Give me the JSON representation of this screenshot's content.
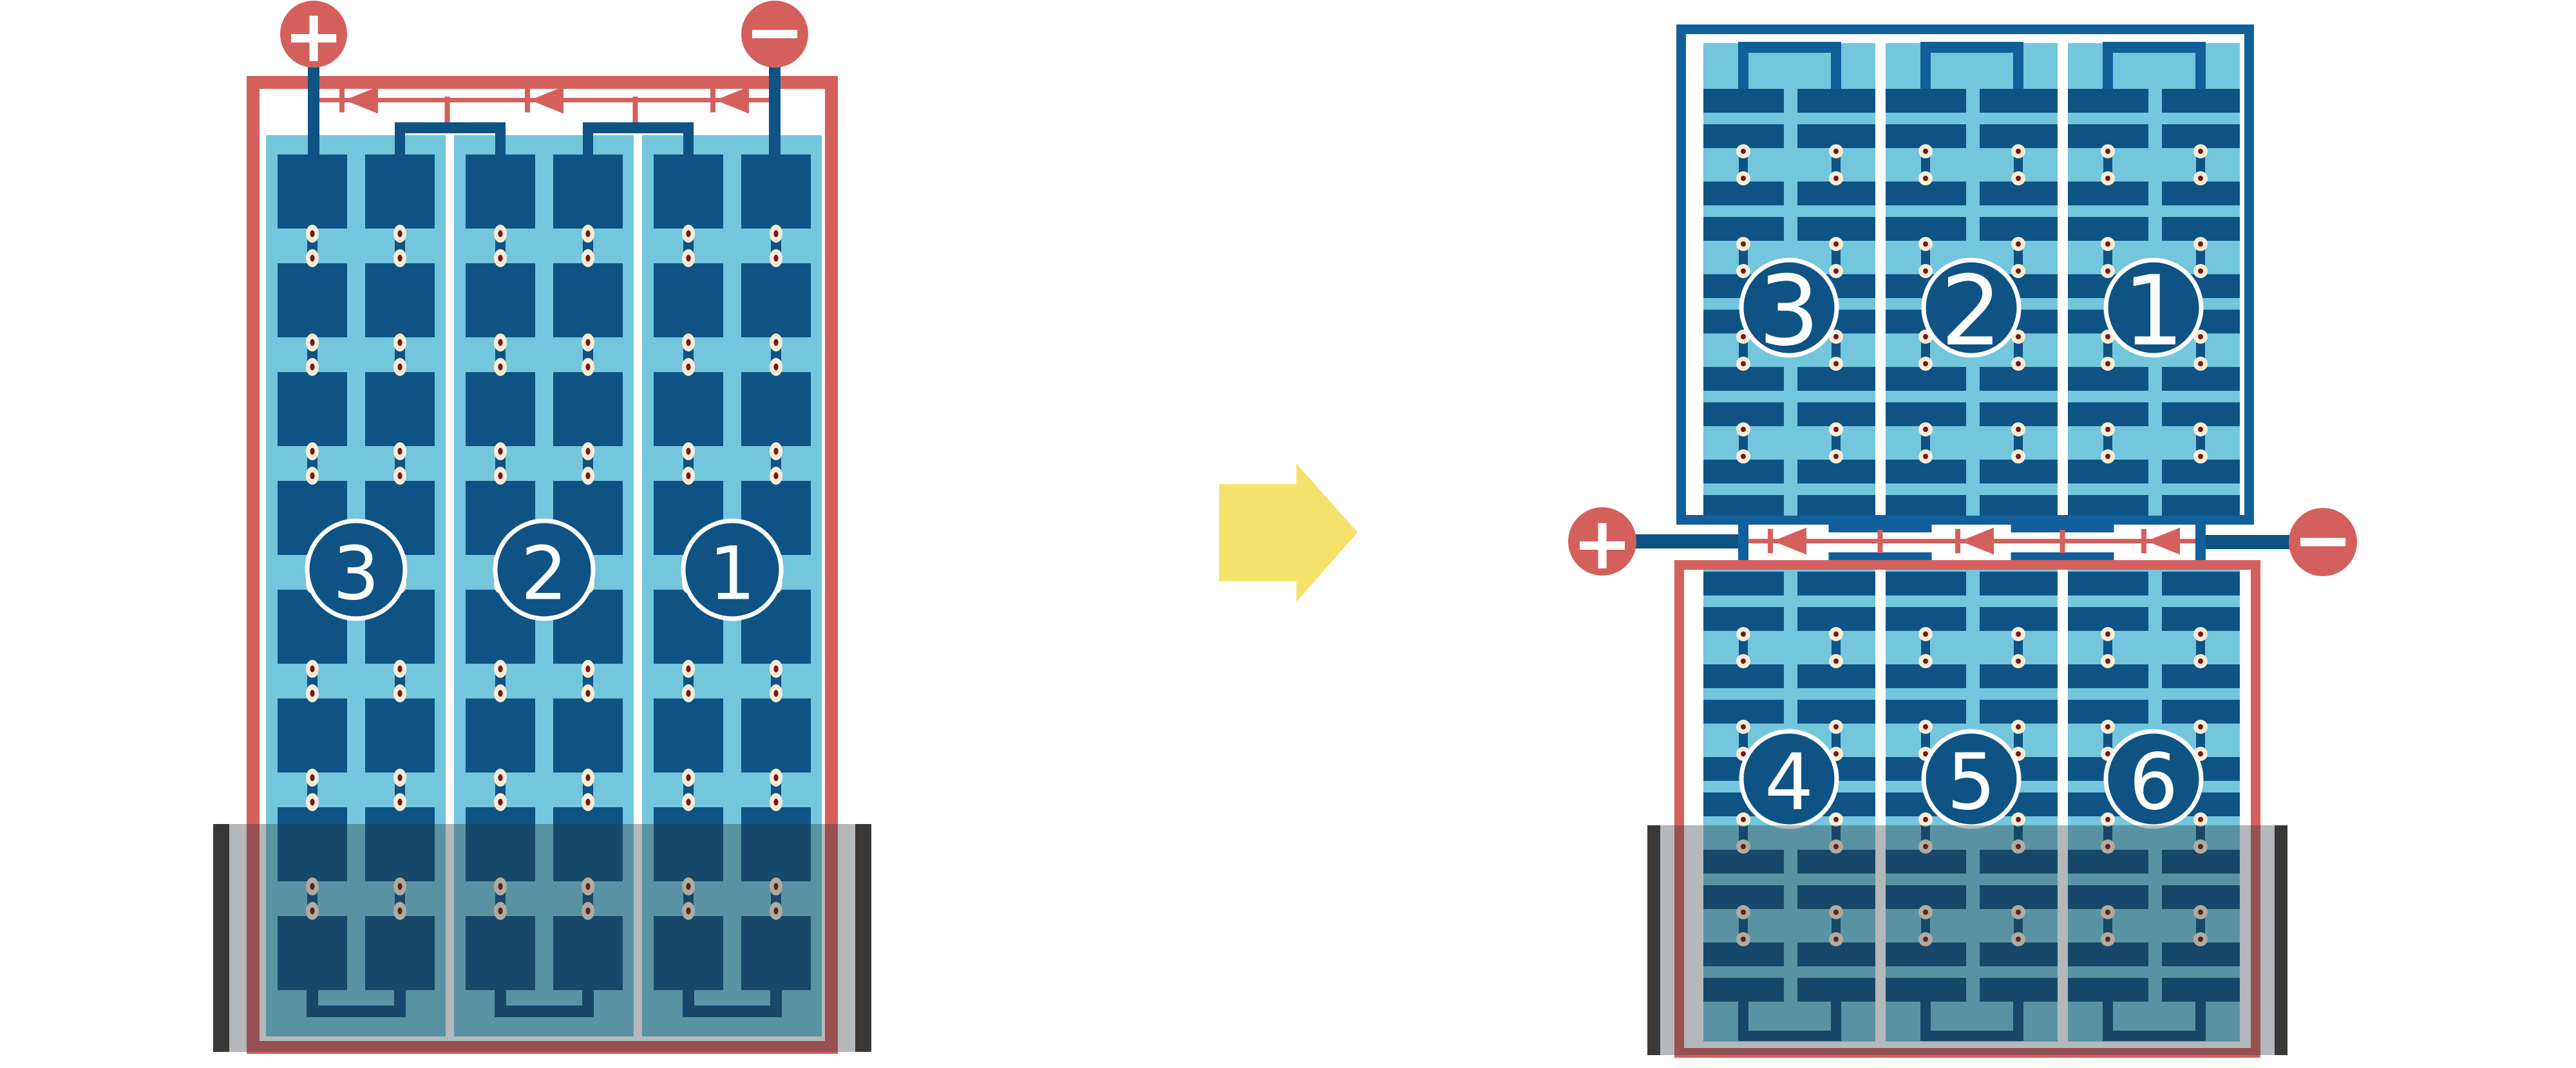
{
  "left_module": {
    "kind": "full-cell module",
    "terminals": {
      "positive": "+",
      "negative": "−"
    },
    "strings": [
      {
        "label": "3"
      },
      {
        "label": "2"
      },
      {
        "label": "1"
      }
    ],
    "bypass_diode_count": 3,
    "shaded_bottom": true
  },
  "right_module": {
    "kind": "half-cut cell module",
    "terminals": {
      "positive": "+",
      "negative": "−"
    },
    "top_half": {
      "strings": [
        {
          "label": "3"
        },
        {
          "label": "2"
        },
        {
          "label": "1"
        }
      ]
    },
    "bottom_half": {
      "strings": [
        {
          "label": "4"
        },
        {
          "label": "5"
        },
        {
          "label": "6"
        }
      ]
    },
    "bypass_diode_count": 3,
    "shaded_bottom": true
  },
  "transition_arrow": {
    "direction": "right"
  },
  "colors": {
    "red": "#D4605D",
    "cell_blue": "#0E5384",
    "border_blue": "#12609B",
    "panel_light_blue": "#73C6DC",
    "solder_cream": "#F7EDD5",
    "solder_maroon": "#7A161B",
    "shade_overlay": "rgba(40,52,58,0.35)",
    "shade_bar_dark": "#3A3836",
    "arrow_yellow": "#F4E26D",
    "background": "#FFFFFF"
  }
}
